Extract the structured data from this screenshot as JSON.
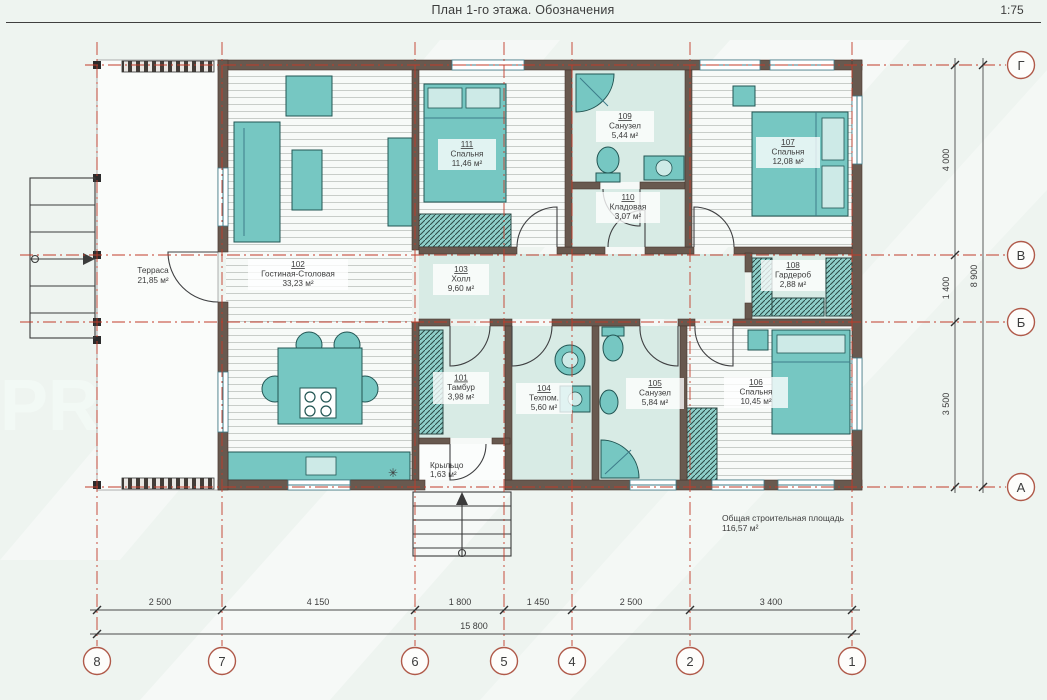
{
  "meta": {
    "title": "План 1-го этажа. Обозначения",
    "scale": "1:75"
  },
  "watermark": {
    "text": "PRO"
  },
  "summary": {
    "label": "Общая строительная площадь",
    "value": "116,57 м²"
  },
  "outdoor": [
    {
      "name": "Терраса",
      "area": "21,85 м²"
    },
    {
      "name": "Крыльцо",
      "area": "1,63 м²"
    }
  ],
  "rooms": [
    {
      "id": "101",
      "name": "Тамбур",
      "area": "3,98 м²"
    },
    {
      "id": "102",
      "name": "Гостиная-Столовая",
      "area": "33,23 м²"
    },
    {
      "id": "103",
      "name": "Холл",
      "area": "9,60 м²"
    },
    {
      "id": "104",
      "name": "Техпом.",
      "area": "5,60 м²"
    },
    {
      "id": "105",
      "name": "Санузел",
      "area": "5,84 м²"
    },
    {
      "id": "106",
      "name": "Спальня",
      "area": "10,45 м²"
    },
    {
      "id": "107",
      "name": "Спальня",
      "area": "12,08 м²"
    },
    {
      "id": "108",
      "name": "Гардероб",
      "area": "2,88 м²"
    },
    {
      "id": "109",
      "name": "Санузел",
      "area": "5,44 м²"
    },
    {
      "id": "110",
      "name": "Кладовая",
      "area": "3,07 м²"
    },
    {
      "id": "111",
      "name": "Спальня",
      "area": "11,46 м²"
    }
  ],
  "axes": {
    "bottom": [
      "8",
      "7",
      "6",
      "5",
      "4",
      "2",
      "1"
    ],
    "right": [
      "Г",
      "В",
      "Б",
      "А"
    ]
  },
  "dims": {
    "bottom": [
      "2 500",
      "4 150",
      "1 800",
      "1 450",
      "2 500",
      "3 400"
    ],
    "bottom_total": "15 800",
    "right": [
      "4 000",
      "1 400",
      "3 500"
    ],
    "right_total": "8 900"
  },
  "colors": {
    "grid-red": "#c13b2a",
    "bubble-red": "#b05a4a",
    "wall": "#68594f",
    "furniture-teal": "#76c7c2",
    "floor-tile": "#d8ebe5",
    "text": "#3c3c3c"
  }
}
